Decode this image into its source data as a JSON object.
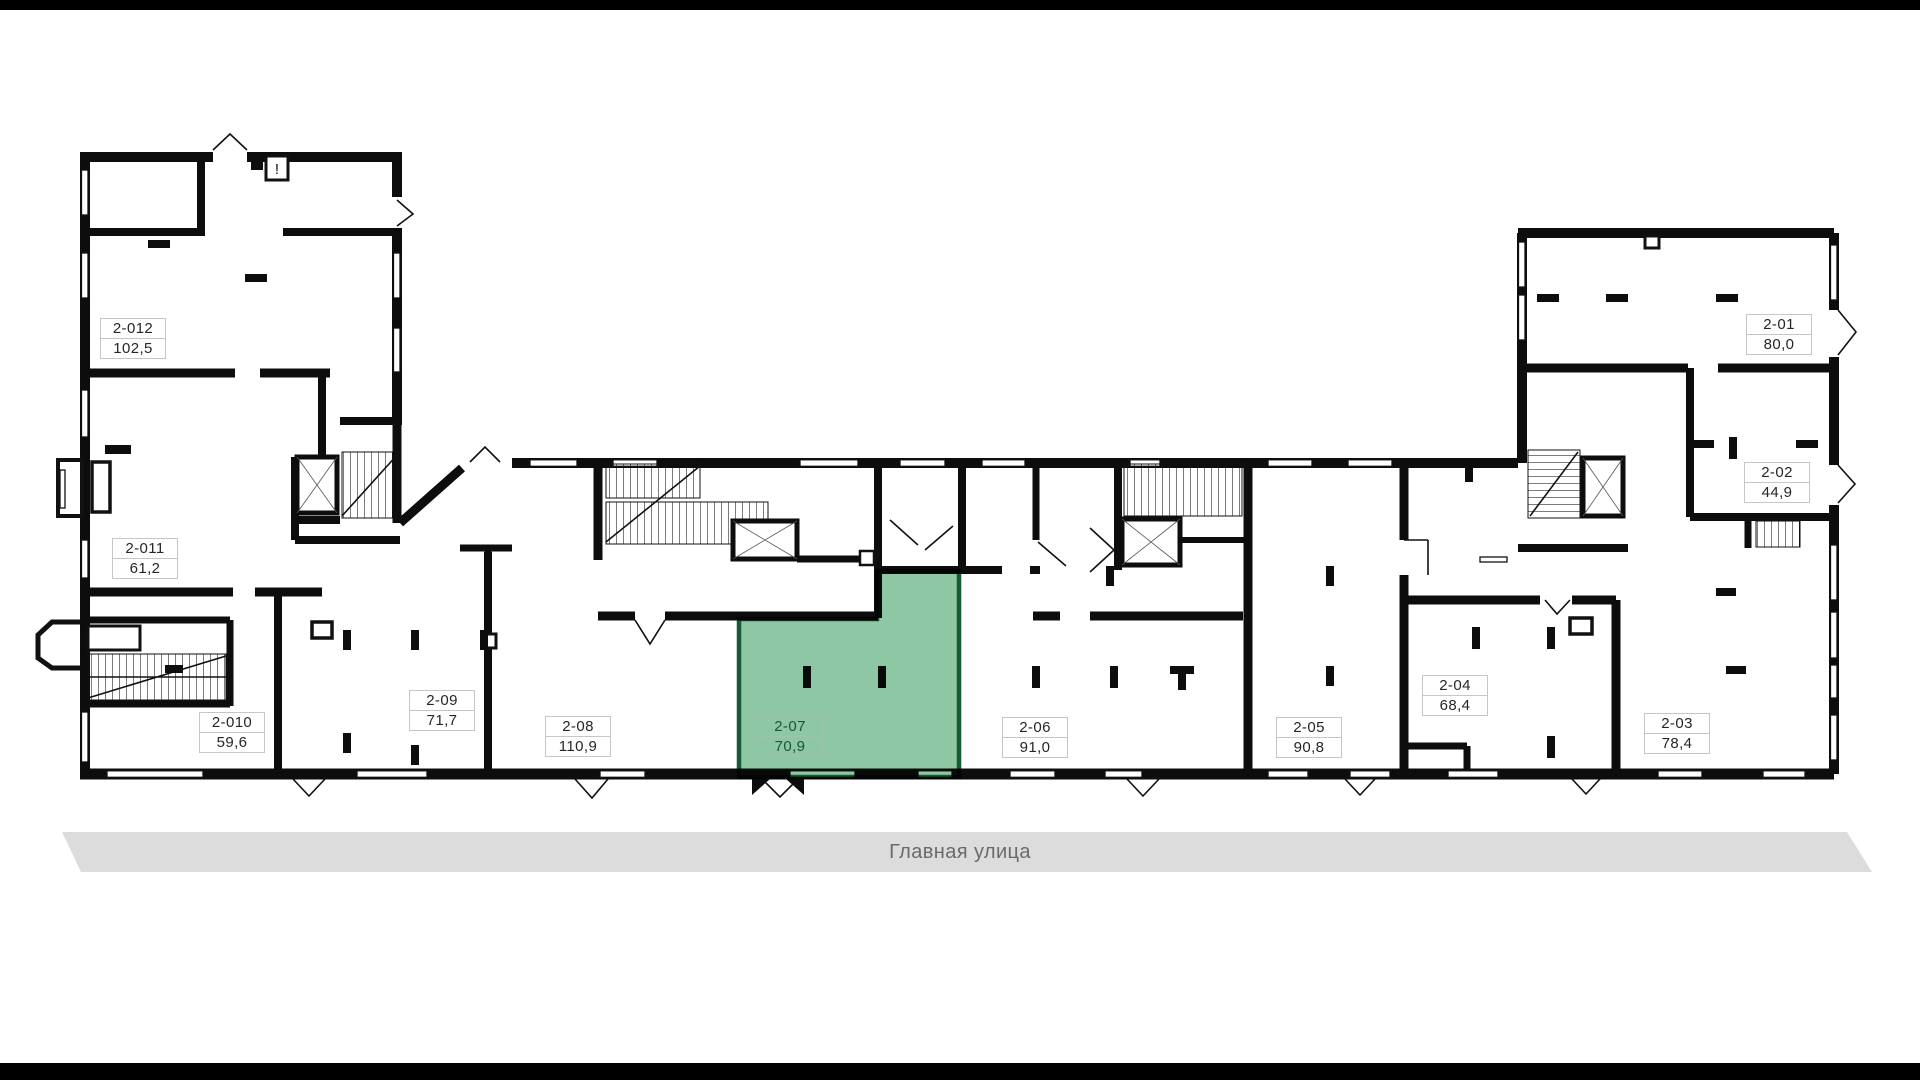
{
  "street": {
    "label": "Главная улица",
    "bg": "#dcdcdc",
    "text_color": "#6a6a6a"
  },
  "colors": {
    "wall": "#0d0d0d",
    "highlight_fill": "#8ec7a4",
    "highlight_stroke": "#175b33",
    "label_border": "#c6c6c6",
    "label_text": "#262626",
    "highlight_label_text": "#1d5434"
  },
  "markers": {
    "warning": "!"
  },
  "units": [
    {
      "id": "2-012",
      "area": "102,5",
      "highlighted": false
    },
    {
      "id": "2-011",
      "area": "61,2",
      "highlighted": false
    },
    {
      "id": "2-010",
      "area": "59,6",
      "highlighted": false
    },
    {
      "id": "2-09",
      "area": "71,7",
      "highlighted": false
    },
    {
      "id": "2-08",
      "area": "110,9",
      "highlighted": false
    },
    {
      "id": "2-07",
      "area": "70,9",
      "highlighted": true
    },
    {
      "id": "2-06",
      "area": "91,0",
      "highlighted": false
    },
    {
      "id": "2-05",
      "area": "90,8",
      "highlighted": false
    },
    {
      "id": "2-04",
      "area": "68,4",
      "highlighted": false
    },
    {
      "id": "2-03",
      "area": "78,4",
      "highlighted": false
    },
    {
      "id": "2-02",
      "area": "44,9",
      "highlighted": false
    },
    {
      "id": "2-01",
      "area": "80,0",
      "highlighted": false
    }
  ]
}
